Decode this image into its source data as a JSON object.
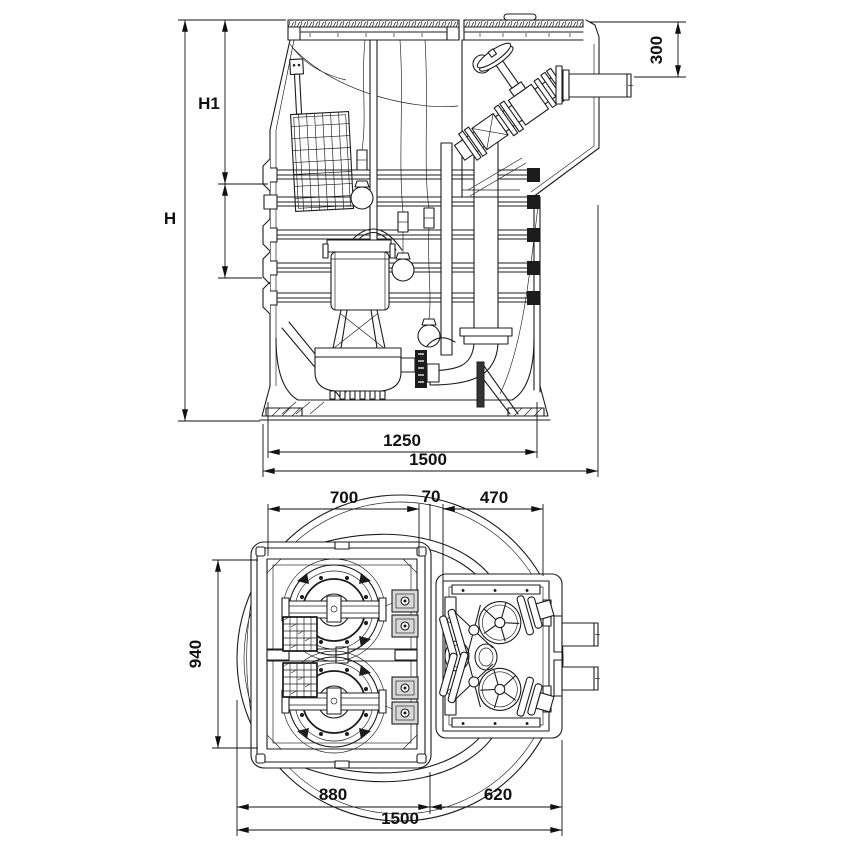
{
  "drawing": {
    "elevation": {
      "dims": {
        "h": "H",
        "h1": "H1",
        "outlet_height": "300",
        "base_width": "1250",
        "overall_width": "1500"
      }
    },
    "plan": {
      "dims": {
        "pump_hatch_width": "700",
        "hatch_gap": "70",
        "valve_hatch_width": "470",
        "hatch_length": "940",
        "left_section_width": "880",
        "right_section_width": "620",
        "overall_width": "1500"
      }
    }
  }
}
